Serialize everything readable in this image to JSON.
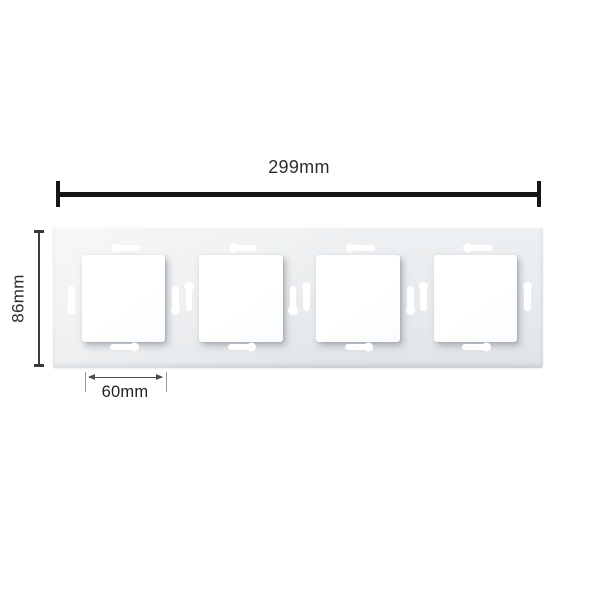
{
  "diagram": {
    "subject": "4-gang glass switch frame, front dimension view",
    "module_count": 4
  },
  "dimensions": {
    "overall_width": {
      "label": "299mm"
    },
    "overall_height": {
      "label": "86mm"
    },
    "module_width": {
      "label": "60mm"
    }
  },
  "colors": {
    "background": "#ffffff",
    "panel": "#e9eced",
    "module_button": "#ffffff",
    "dimension_line_primary": "#161616",
    "dimension_line_secondary": "#4d4d4d",
    "dimension_text": "#2e2e2e"
  }
}
